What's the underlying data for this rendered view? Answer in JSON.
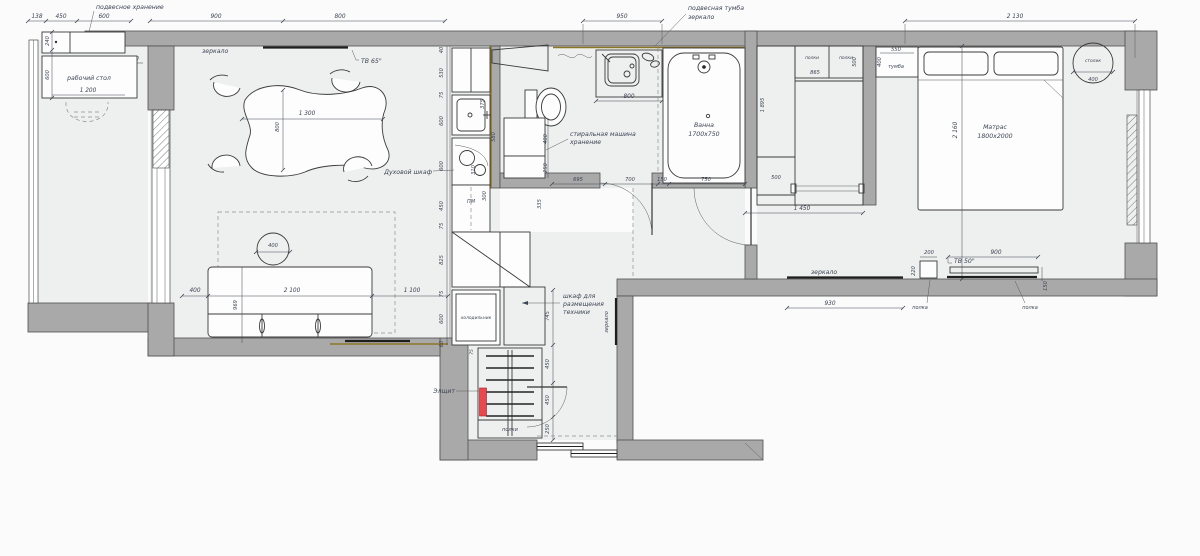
{
  "plan": {
    "balcony": {
      "hanging": "подвесное хранение",
      "desk": "рабочий стол",
      "desk_w": "1 200",
      "top": [
        "138",
        "450",
        "600"
      ],
      "v240": "240",
      "v600": "600",
      "d310": "310"
    },
    "living": {
      "mirror": "зеркало",
      "tv": "ТВ 65\"",
      "top": [
        "900",
        "800"
      ],
      "table_w": "1 300",
      "table_d": "800",
      "coffee": "400",
      "sofa_left": "400",
      "sofa_w": "2 100",
      "sofa_right": "1 100",
      "sofa_d": "969"
    },
    "kitchen": {
      "oven": "Духовой шкаф",
      "dw": "ПМ",
      "chain": [
        "40",
        "530",
        "75",
        "600",
        "600",
        "450",
        "75",
        "825",
        "75",
        "600",
        "60"
      ],
      "inner": [
        "375",
        "580",
        "310",
        "300"
      ],
      "d335": "335"
    },
    "bath": {
      "top": "950",
      "vanity1": "подвесная тумба",
      "vanity2": "зеркало",
      "sink_w": "800",
      "tub1": "Ванна",
      "tub2": "1700x750",
      "wash1": "стиральная машина",
      "wash2": "хранение",
      "w400": "400",
      "w250": "250",
      "chain": [
        "695",
        "700",
        "150",
        "750"
      ]
    },
    "hall": {
      "fridge": "холодильник",
      "tech1": "шкаф для",
      "tech2": "размещения",
      "tech3": "техники",
      "mirror": "зеркало",
      "panel": "Элщит",
      "shelves": "полки",
      "gap75": "75",
      "chain": [
        "745",
        "450",
        "450",
        "250"
      ]
    },
    "wardrobe": {
      "p1": "полки",
      "p2": "полки",
      "d865": "865",
      "d500v": "500",
      "d1895": "1 895",
      "d500": "500",
      "w": "1 450"
    },
    "tumba": {
      "label": "тумба",
      "w": "550",
      "d": "400"
    },
    "bedroom": {
      "top": "2 130",
      "side": "2 160",
      "mat1": "Матрас",
      "mat2": "1800x2000",
      "stol": "столик",
      "stol_d": "400",
      "mirror": "зеркало",
      "mirror_w": "930",
      "s1w": "200",
      "s1d": "220",
      "shelf1": "полка",
      "tv": "ТВ 50\"",
      "tv_w": "900",
      "d150": "150",
      "shelf2": "полка"
    }
  }
}
